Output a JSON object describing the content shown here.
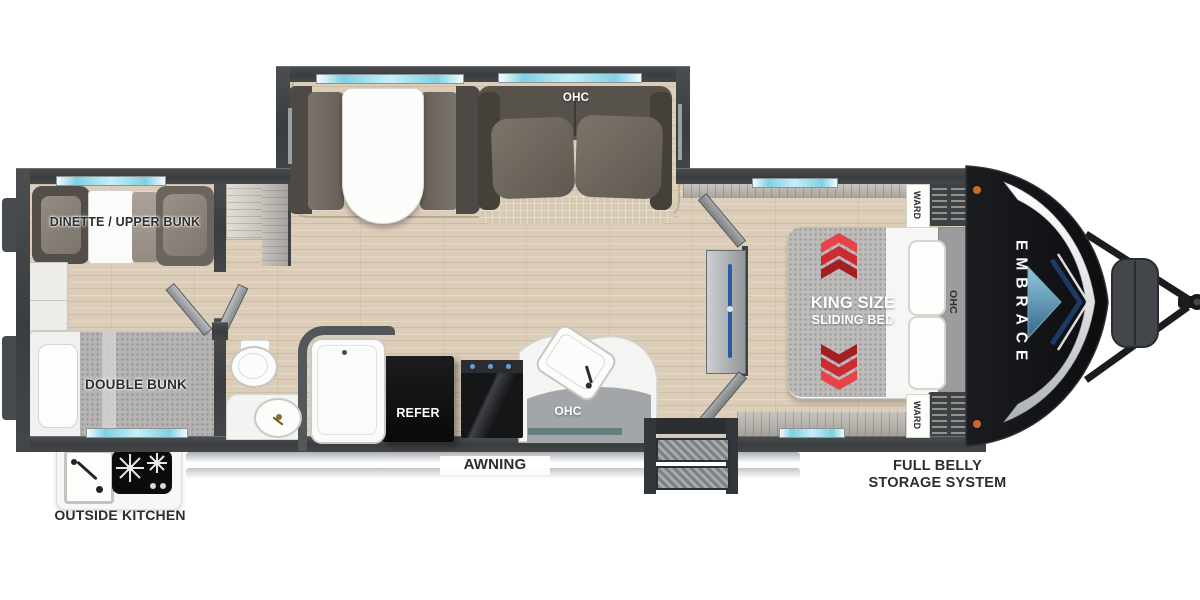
{
  "scene": {
    "type": "travel-trailer-floorplan",
    "background": "#ffffff"
  },
  "brand": {
    "front_cap": "EMBRACE"
  },
  "rooms": {
    "bunk_room": {
      "dinette_label": "DINETTE / UPPER BUNK",
      "double_bunk_label": "DOUBLE BUNK"
    },
    "living_slideout": {
      "ohc_label": "OHC"
    },
    "kitchen": {
      "refrigerator_label": "REFER",
      "ohc_label": "OHC"
    },
    "bedroom": {
      "bed_line1": "KING SIZE",
      "bed_line2": "SLIDING BED",
      "ohc_label": "OHC",
      "wardrobe_top_label": "WARD",
      "wardrobe_bottom_label": "WARD"
    }
  },
  "exterior": {
    "awning_label": "AWNING",
    "storage_line1": "FULL BELLY",
    "storage_line2": "STORAGE SYSTEM",
    "outside_kitchen_label": "OUTSIDE KITCHEN"
  },
  "icons": {
    "toilet": "toilet-icon",
    "bath_tub": "bath-tub-icon",
    "bathroom_sink": "bathroom-sink-icon",
    "kitchen_sink": "kitchen-sink-icon",
    "range_cooktop": "range-cooktop-icon",
    "outside_sink": "outside-sink-icon",
    "outside_cooktop": "outside-cooktop-icon",
    "wardrobe_clothes": "wardrobe-clothes-icon",
    "tv": "tv-icon",
    "entry_steps": "entry-steps-icon",
    "propane_tanks": "propane-tanks-icon",
    "hitch": "hitch-icon",
    "sliding_bed_arrows": "red-chevron-arrows-icon",
    "front_cap_arrow": "blue-arrow-icon"
  },
  "colors": {
    "wall": "#3e4144",
    "floor_wood": "#dccdb9",
    "weathered_wood": "#b8b4ad",
    "window_cyan": "#7fd0e3",
    "accent_red": "#cd2a31",
    "cap_black": "#141518",
    "cap_silver": "#e3e5e6",
    "cap_navy": "#1d3a66",
    "cap_blue": "#5f93ad",
    "marker_orange": "#c96a2a",
    "refrigerator_black": "#111113"
  }
}
